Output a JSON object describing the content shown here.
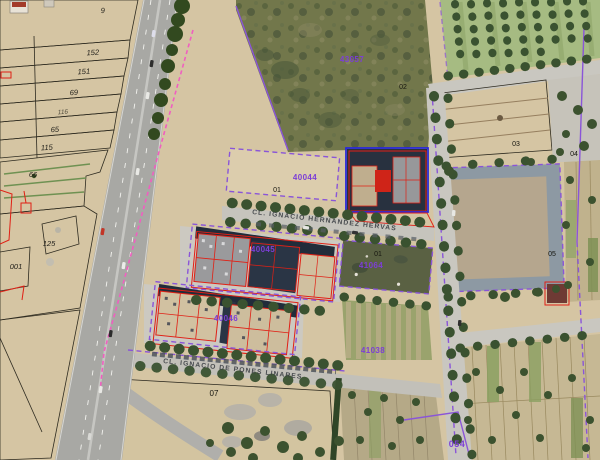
{
  "map": {
    "view": "aerial-orthophoto-with-cadastral-overlay",
    "streets": [
      {
        "name": "CL. IGNACIO HERNANDEZ HERVAS"
      },
      {
        "name": "CL. IGNACIO DE PONES LINARES"
      }
    ],
    "cadastral_refs": [
      {
        "text": "43057"
      },
      {
        "text": "40044"
      },
      {
        "text": "40045"
      },
      {
        "text": "41064"
      },
      {
        "text": "40046"
      },
      {
        "text": "41038"
      },
      {
        "text": "054"
      }
    ],
    "parcel_numbers": [
      {
        "text": "9"
      },
      {
        "text": "152"
      },
      {
        "text": "151"
      },
      {
        "text": "69"
      },
      {
        "text": "116"
      },
      {
        "text": "65"
      },
      {
        "text": "115"
      },
      {
        "text": "66"
      },
      {
        "text": "125"
      },
      {
        "text": "001"
      },
      {
        "text": "07"
      }
    ],
    "block_numbers": [
      {
        "text": "01"
      },
      {
        "text": "02"
      },
      {
        "text": "03"
      },
      {
        "text": "04"
      },
      {
        "text": "05"
      },
      {
        "text": "01"
      }
    ],
    "colors": {
      "cadastral_red": "#e02015",
      "boundary_purple": "#8a55d8",
      "label_purple": "#7c3ed6",
      "urban_blue": "#2a2ad8",
      "limit_pink": "#f05fc0",
      "sand": "#d5c5a3"
    }
  }
}
